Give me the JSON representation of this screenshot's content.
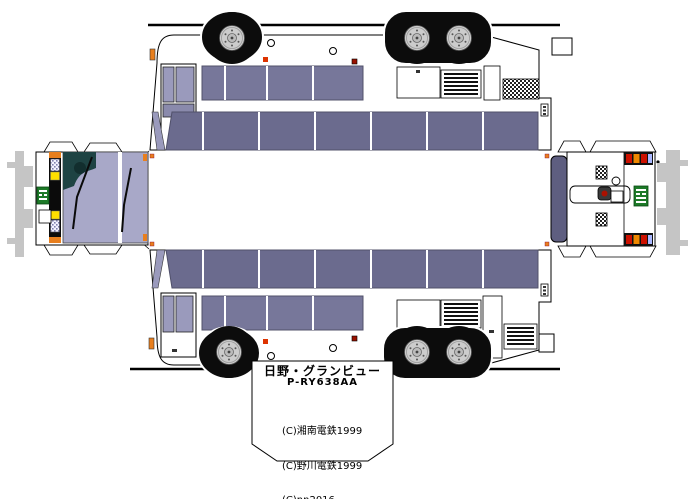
{
  "sheet": {
    "model_name": "日野・グランビュー",
    "model_code": "P-RY638AA",
    "credits": [
      "(C)湘南電鉄1999",
      "(C)野川電鉄1999",
      "(C)nn2016"
    ]
  },
  "colors": {
    "body_white": "#ffffff",
    "window_main": "#77779a",
    "window_upper": "#6b6b8e",
    "door_glass": "#9a9abc",
    "windshield": "#a8a8c8",
    "rear_window": "#5e5e80",
    "marker_orange": "#e87f1e",
    "signal_yellow": "#ffdf00",
    "tail_red": "#cc1100",
    "tail_amber": "#ee8800",
    "reverse_blue": "#aab8ff",
    "plate_green": "#1d7a28",
    "shadow_gray": "#c5c5c5",
    "tire_black": "#0c0c0c",
    "driver_teal": "#1e4343"
  }
}
